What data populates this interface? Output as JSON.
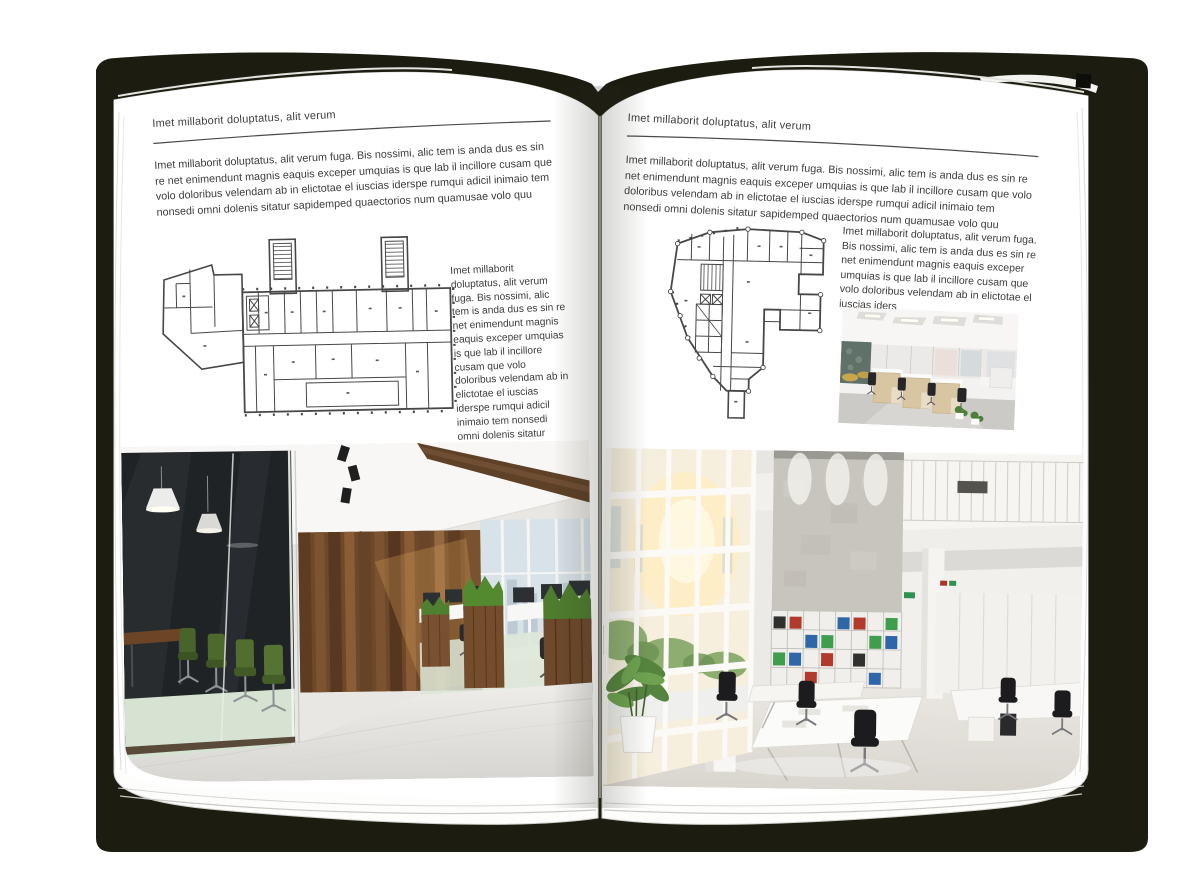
{
  "book": {
    "left_page": {
      "header": "Imet millaborit doluptatus, alit verum",
      "intro": "Imet millaborit doluptatus, alit verum fuga. Bis nossimi, alic tem is anda dus es sin re net enimendunt magnis eaquis exceper umquias is que lab il incillore cusam que volo doloribus velendam ab in elictotae el iuscias iderspe rumqui adicil inimaio tem nonsedi omni dolenis sitatur sapidemped quaectorios num quamusae volo quu",
      "caption": "Imet millaborit doluptatus, alit verum fuga. Bis nossimi, alic tem is anda dus es sin re net enimendunt magnis eaquis exceper umquias is que lab il incillore cusam que volo doloribus velendam ab in elictotae el iuscias iderspe rumqui adicil inimaio tem nonsedi omni dolenis sitatur sapidemped quaectorios num quamusae volo quu"
    },
    "right_page": {
      "header": "Imet millaborit doluptatus, alit verum",
      "intro": "Imet millaborit doluptatus, alit verum fuga. Bis nossimi, alic tem is anda dus es sin re net enimendunt magnis eaquis exceper umquias is que lab il incillore cusam que volo doloribus velendam ab in elictotae el iuscias iderspe rumqui adicil inimaio tem nonsedi omni dolenis sitatur sapidemped quaectorios num quamusae volo quu",
      "caption": "Imet millaborit doluptatus, alit verum fuga. Bis nossimi, alic tem is anda dus es sin re net enimendunt magnis eaquis exceper umquias is que lab il incillore cusam que volo doloribus velendam ab in elictotae el iuscias iders"
    }
  },
  "colors": {
    "cover": "#1d1c10",
    "page": "#ffffff",
    "text": "#3c3c3c",
    "rule": "#4a4a4a",
    "plan_line": "#474747",
    "wood": "#6d4829",
    "plant_green": "#4e7d2e",
    "binder_red": "#b23a2c",
    "binder_blue": "#2f66a8",
    "binder_green": "#3f9e4d"
  }
}
